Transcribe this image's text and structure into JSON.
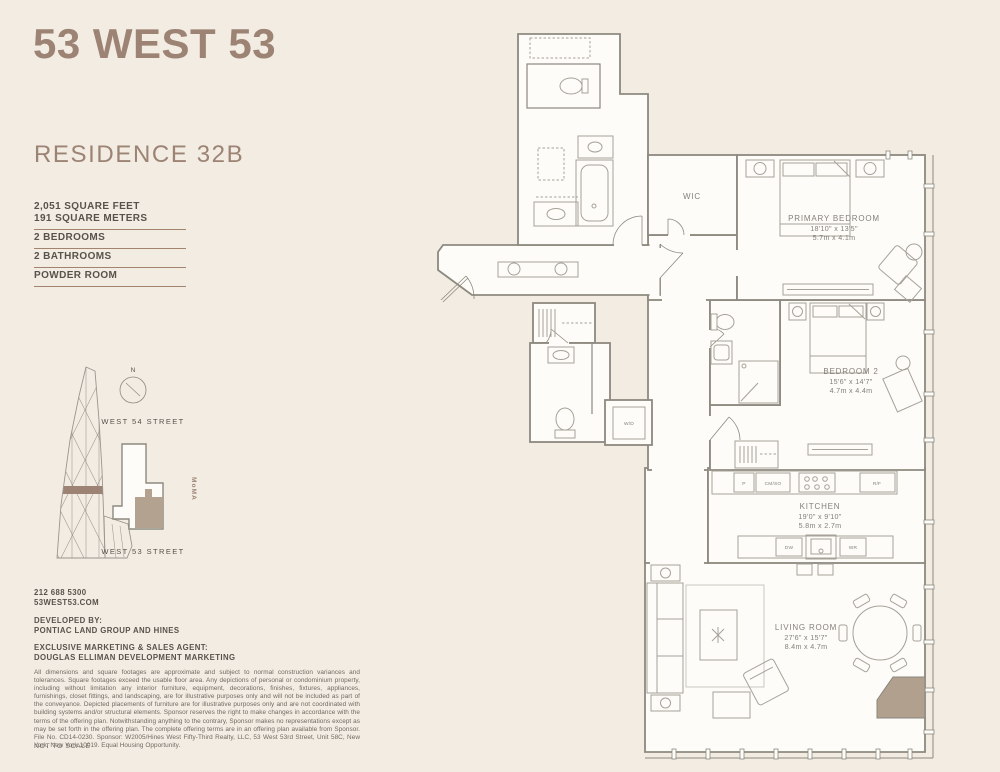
{
  "colors": {
    "background": "#f2ece3",
    "accent_taupe": "#9c8374",
    "text_dark": "#57524b",
    "wall_gray": "#8d897f",
    "unit_highlight": "#b2a28f"
  },
  "sidebar": {
    "building_name": "53 WEST 53",
    "residence": "RESIDENCE 32B",
    "stats": [
      {
        "lines": [
          "2,051 SQUARE FEET",
          "191 SQUARE METERS"
        ]
      },
      {
        "lines": [
          "2 BEDROOMS"
        ]
      },
      {
        "lines": [
          "2 BATHROOMS"
        ]
      },
      {
        "lines": [
          "POWDER ROOM"
        ]
      }
    ],
    "sitemap": {
      "north": "N",
      "street_top": "WEST 54 STREET",
      "street_bottom": "WEST 53 STREET",
      "landmark": "MoMA"
    },
    "contact": {
      "phone": "212 688 5300",
      "website": "53WEST53.COM"
    },
    "developer": {
      "label": "DEVELOPED BY:",
      "name": "PONTIAC LAND GROUP AND HINES"
    },
    "agent": {
      "label": "EXCLUSIVE MARKETING & SALES AGENT:",
      "name": "DOUGLAS ELLIMAN DEVELOPMENT MARKETING"
    },
    "legal": {
      "disclaimer": "All dimensions and square footages are approximate and subject to normal construction variances and tolerances. Square footages exceed the usable floor area. Any depictions of personal or condominium property, including without limitation any interior furniture, equipment, decorations, finishes, fixtures, appliances, furnishings, closet fittings, and landscaping, are for illustrative purposes only and will not be included as part of the conveyance. Depicted placements of furniture are for illustrative purposes only and are not coordinated with building systems and/or structural elements. Sponsor reserves the right to make changes in accordance with the terms of the offering plan. Notwithstanding anything to the contrary, Sponsor makes no representations except as may be set forth in the offering plan. The complete offering terms are in an offering plan available from Sponsor. File No. CD14-0230. Sponsor: W2005/Hines West Fifty-Third Realty, LLC, 53 West 53rd Street, Unit 58C, New York, New York 10019. Equal Housing Opportunity.",
      "scale_note": "NOT TO SCALE"
    }
  },
  "plan": {
    "rooms": {
      "wic": {
        "name": "WIC"
      },
      "primary_bedroom": {
        "name": "PRIMARY BEDROOM",
        "imperial": "18'10\" x 13'5\"",
        "metric": "5.7m x 4.1m"
      },
      "bedroom_2": {
        "name": "BEDROOM 2",
        "imperial": "15'6\" x 14'7\"",
        "metric": "4.7m x 4.4m"
      },
      "kitchen": {
        "name": "KITCHEN",
        "imperial": "19'0\" x 9'10\"",
        "metric": "5.8m x 2.7m"
      },
      "living_room": {
        "name": "LIVING ROOM",
        "imperial": "27'6\" x 15'7\"",
        "metric": "8.4m x 4.7m"
      },
      "laundry": {
        "name": "W/D"
      }
    },
    "appliances": {
      "pantry": "P",
      "speed_oven": "CM/SO",
      "fridge": "R/F",
      "dishwasher": "DW",
      "wine_fridge": "WR"
    }
  }
}
